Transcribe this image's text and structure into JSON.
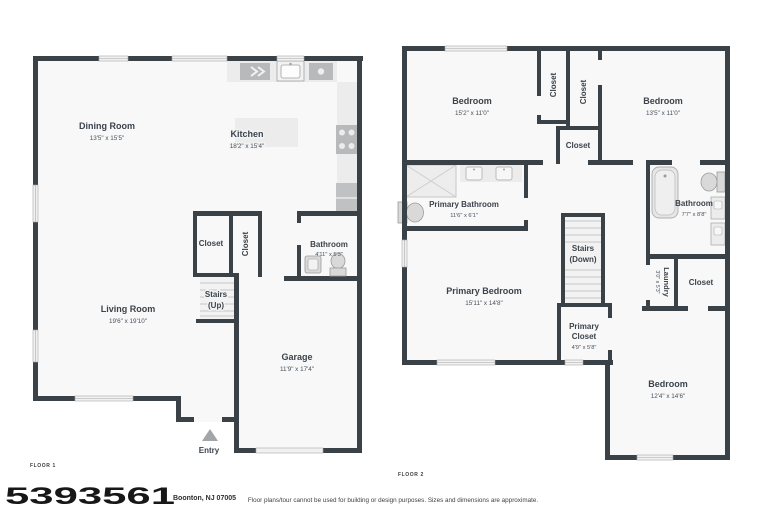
{
  "page": {
    "mls_number": "5393561",
    "address": "Boonton, NJ 07005",
    "disclaimer": "Floor plans/tour cannot be used for building or design purposes. Sizes and dimensions are approximate."
  },
  "colors": {
    "wall": "#3a4147",
    "floor": "#f8f8f8",
    "label": "#3b434b",
    "fixture": "#d9d9d9"
  },
  "floor1": {
    "label": "FLOOR 1",
    "rooms": {
      "dining": {
        "name": "Dining Room",
        "dims": "13'5\" x 15'5\""
      },
      "kitchen": {
        "name": "Kitchen",
        "dims": "18'2\" x 15'4\""
      },
      "living": {
        "name": "Living Room",
        "dims": "19'6\" x 19'10\""
      },
      "closet1": {
        "name": "Closet"
      },
      "closet2": {
        "name": "Closet"
      },
      "stairs": {
        "name": "Stairs",
        "sub": "(Up)"
      },
      "bathroom": {
        "name": "Bathroom",
        "dims": "4'11\" x 5'3\""
      },
      "garage": {
        "name": "Garage",
        "dims": "11'9\" x 17'4\""
      },
      "entry": {
        "name": "Entry"
      }
    }
  },
  "floor2": {
    "label": "FLOOR 2",
    "rooms": {
      "bedroom1": {
        "name": "Bedroom",
        "dims": "15'2\" x 11'0\""
      },
      "closet_a": {
        "name": "Closet"
      },
      "closet_b": {
        "name": "Closet"
      },
      "bedroom2": {
        "name": "Bedroom",
        "dims": "13'5\" x 11'0\""
      },
      "closet_mid": {
        "name": "Closet"
      },
      "primary_bathroom": {
        "name": "Primary Bathroom",
        "dims": "11'6\" x 6'1\""
      },
      "bathroom": {
        "name": "Bathroom",
        "dims": "7'7\" x 8'8\""
      },
      "stairs": {
        "name": "Stairs",
        "sub": "(Down)"
      },
      "primary_bedroom": {
        "name": "Primary Bedroom",
        "dims": "15'11\" x 14'8\""
      },
      "primary_closet": {
        "name_line1": "Primary",
        "name_line2": "Closet",
        "dims": "4'9\" x 5'8\""
      },
      "laundry": {
        "name": "Laundry",
        "dims": "3'0\" x 5'3\""
      },
      "closet_r": {
        "name": "Closet"
      },
      "bedroom3": {
        "name": "Bedroom",
        "dims": "12'4\" x 14'6\""
      }
    }
  }
}
